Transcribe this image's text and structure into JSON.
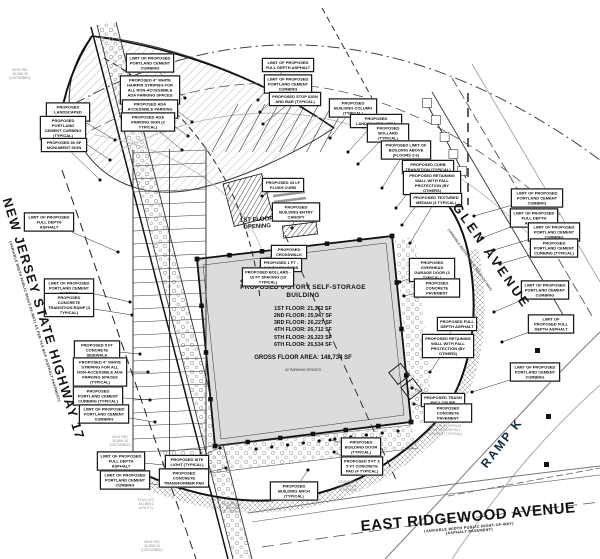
{
  "roads": {
    "nj17": {
      "name": "NEW JERSEY STATE HIGHWAY 17",
      "sub": "(VARIABLE WIDTH PUBLIC RIGHT-OF-WAY) AS PER TAX MAP (ASPHALT PAVEMENT)"
    },
    "glen": {
      "name": "GLEN AVENUE",
      "sub": "(VARIABLE WIDTH PUBLIC RIGHT-OF-WAY)"
    },
    "ramp_k": {
      "name": "RAMP K"
    },
    "east_ridgewood": {
      "name": "EAST RIDGEWOOD AVENUE",
      "sub1": "(VARIABLE WIDTH PUBLIC RIGHT-OF-WAY)",
      "sub2": "(ASPHALT PAVEMENT)"
    }
  },
  "building": {
    "title": "PROPOSED 6-STORY SELF-STORAGE BUILDING",
    "floors": [
      "1ST FLOOR: 21,362 SF",
      "2ND FLOOR: 25,947 SF",
      "3RD FLOOR: 26,227 SF",
      "4TH FLOOR: 26,712 SF",
      "5TH FLOOR: 26,323 SF",
      "6TH FLOOR: 26,534 SF"
    ],
    "gross": "GROSS FLOOR AREA: 148,734 SF",
    "parking": "42 PARKING SPACES",
    "opening_label": "1ST FLOOR OPENING"
  },
  "callouts": [
    {
      "text": "LIMIT OF PROPOSED PORTLAND CEMENT CURBING",
      "x": 150,
      "y": 63,
      "w": 42,
      "tx": 185,
      "ty": 98
    },
    {
      "text": "PROPOSED 4\" WHITE HAIRPIN STRIPING FOR ALL NON-ACCESSIBLE ADA PARKING SPACES (TYPICAL)",
      "x": 150,
      "y": 90,
      "w": 54,
      "tx": 192,
      "ty": 122
    },
    {
      "text": "PROPOSED ADA ACCESSIBLE PARKING AREA",
      "x": 150,
      "y": 109,
      "w": 50,
      "tx": 188,
      "ty": 136
    },
    {
      "text": "PROPOSED ADA PARKING SIGN (2 TYPICAL)",
      "x": 148,
      "y": 122,
      "w": 48,
      "tx": 182,
      "ty": 150
    },
    {
      "text": "PROPOSED LANDSCAPED AREA",
      "x": 68,
      "y": 112,
      "w": 38,
      "tx": 115,
      "ty": 140
    },
    {
      "text": "PROPOSED PORTLAND CEMENT CURBING (TYPICAL)",
      "x": 63,
      "y": 128,
      "w": 40,
      "tx": 110,
      "ty": 160
    },
    {
      "text": "PROPOSED 80 SF MONUMENT SIGN",
      "x": 64,
      "y": 145,
      "w": 40,
      "tx": 100,
      "ty": 180
    },
    {
      "text": "LIMIT OF PROPOSED FULL DEPTH ASPHALT",
      "x": 288,
      "y": 65,
      "w": 46,
      "tx": 258,
      "ty": 100
    },
    {
      "text": "LIMIT OF PROPOSED PORTLAND CEMENT CURBING",
      "x": 288,
      "y": 84,
      "w": 42,
      "tx": 260,
      "ty": 112
    },
    {
      "text": "PROPOSED STOP SIGN AND BAR (TYPICAL)",
      "x": 295,
      "y": 99,
      "w": 46,
      "tx": 263,
      "ty": 124
    },
    {
      "text": "PROPOSED BUILDING COLUMN (TYPICAL)",
      "x": 353,
      "y": 108,
      "w": 42,
      "tx": 330,
      "ty": 138
    },
    {
      "text": "PROPOSED LANDSCAPED AREA",
      "x": 376,
      "y": 121,
      "w": 46,
      "tx": 348,
      "ty": 152
    },
    {
      "text": "PROPOSED BOLLARD (TYPICAL)",
      "x": 388,
      "y": 133,
      "w": 36,
      "tx": 358,
      "ty": 164
    },
    {
      "text": "PROPOSED LIMIT OF BUILDING ABOVE (FLOORS 2-6)",
      "x": 406,
      "y": 150,
      "w": 44,
      "tx": 382,
      "ty": 188
    },
    {
      "text": "PROPOSED CURB TRANSITION (TYPICAL)",
      "x": 428,
      "y": 167,
      "w": 46,
      "tx": 396,
      "ty": 208
    },
    {
      "text": "PROPOSED RETAINING WALL WITH FALL PROTECTION (BY OTHERS)",
      "x": 432,
      "y": 183,
      "w": 52,
      "tx": 402,
      "ty": 225
    },
    {
      "text": "PROPOSED TEXTURED MEDIAN (3 TYPICAL)",
      "x": 436,
      "y": 200,
      "w": 46,
      "tx": 410,
      "ty": 243
    },
    {
      "text": "LIMIT OF PROPOSED FULL DEPTH ASPHALT",
      "x": 49,
      "y": 222,
      "w": 44,
      "tx": 118,
      "ty": 252
    },
    {
      "text": "LIMIT OF PROPOSED PORTLAND CEMENT CURBING",
      "x": 69,
      "y": 288,
      "w": 44,
      "tx": 130,
      "ty": 302
    },
    {
      "text": "PROPOSED CONCRETE TRANSITION RAMP (3 TYPICAL)",
      "x": 69,
      "y": 305,
      "w": 44,
      "tx": 132,
      "ty": 315
    },
    {
      "text": "PROPOSED 5 FT CONCRETE SIDEWALK",
      "x": 97,
      "y": 350,
      "w": 40,
      "tx": 140,
      "ty": 354
    },
    {
      "text": "PROPOSED 4\" WHITE STRIPING FOR ALL NON-ACCESSIBLE ADA PARKING SPACES (TYPICAL)",
      "x": 100,
      "y": 372,
      "w": 48,
      "tx": 148,
      "ty": 372
    },
    {
      "text": "PROPOSED PORTLAND CEMENT CURBING (TYPICAL)",
      "x": 98,
      "y": 396,
      "w": 44,
      "tx": 150,
      "ty": 400
    },
    {
      "text": "LIMIT OF PROPOSED PORTLAND CEMENT CURBING",
      "x": 104,
      "y": 414,
      "w": 44,
      "tx": 155,
      "ty": 422
    },
    {
      "text": "LIMIT OF PROPOSED FULL DEPTH ASPHALT",
      "x": 121,
      "y": 461,
      "w": 42,
      "tx": 176,
      "ty": 466
    },
    {
      "text": "LIMIT OF PROPOSED PORTLAND CEMENT CURBING",
      "x": 125,
      "y": 480,
      "w": 44,
      "tx": 180,
      "ty": 488
    },
    {
      "text": "LIMIT OF PROPOSED PORTLAND CEMENT CURBING",
      "x": 537,
      "y": 198,
      "w": 46,
      "tx": 474,
      "ty": 216
    },
    {
      "text": "LIMIT OF PROPOSED FULL DEPTH ASPHALT",
      "x": 534,
      "y": 218,
      "w": 42,
      "tx": 482,
      "ty": 238
    },
    {
      "text": "LIMIT OF PROPOSED PORTLAND CEMENT CURBING",
      "x": 554,
      "y": 232,
      "w": 46,
      "tx": 494,
      "ty": 250
    },
    {
      "text": "PROPOSED PORTLAND CEMENT CURBING (TYPICAL)",
      "x": 554,
      "y": 248,
      "w": 42,
      "tx": 500,
      "ty": 264
    },
    {
      "text": "LIMIT OF PROPOSED PORTLAND CEMENT CURBING",
      "x": 545,
      "y": 290,
      "w": 42,
      "tx": 494,
      "ty": 312
    },
    {
      "text": "LIMIT OF PROPOSED FULL DEPTH ASPHALT",
      "x": 551,
      "y": 324,
      "w": 40,
      "tx": 502,
      "ty": 342
    },
    {
      "text": "PROPOSED FULL DEPTH ASPHALT",
      "x": 457,
      "y": 324,
      "w": 34,
      "tx": 440,
      "ty": 346
    },
    {
      "text": "PROPOSED RETAINING WALL WITH FALL PROTECTION (BY OTHERS)",
      "x": 448,
      "y": 346,
      "w": 46,
      "tx": 430,
      "ty": 372
    },
    {
      "text": "LIMIT OF PROPOSED PORTLAND CEMENT CURBING",
      "x": 535,
      "y": 372,
      "w": 44,
      "tx": 472,
      "ty": 392
    },
    {
      "text": "PROPOSED 33 LF FLUSH CURB",
      "x": 283,
      "y": 185,
      "w": 36,
      "tx": 262,
      "ty": 196
    },
    {
      "text": "PROPOSED BUILDING ENTRY CANOPY",
      "x": 296,
      "y": 212,
      "w": 42,
      "tx": 292,
      "ty": 228
    },
    {
      "text": "PROPOSED CROSSWALK",
      "x": 289,
      "y": 252,
      "w": 30,
      "tx": 272,
      "ty": 256
    },
    {
      "text": "PROPOSED 1 FT - 0 IN FLUSH CURB",
      "x": 281,
      "y": 265,
      "w": 36,
      "tx": 260,
      "ty": 268
    },
    {
      "text": "PROPOSED BOLLARD - 10 FT SPACING (10 TYPICAL)",
      "x": 268,
      "y": 277,
      "w": 46,
      "tx": 242,
      "ty": 281
    },
    {
      "text": "PROPOSED OVERHEAD GARAGE DOOR (3 TYPICAL)",
      "x": 432,
      "y": 270,
      "w": 40,
      "tx": 400,
      "ty": 282
    },
    {
      "text": "PROPOSED CONCRETE PAVEMENT",
      "x": 437,
      "y": 288,
      "w": 40,
      "tx": 404,
      "ty": 296
    },
    {
      "text": "PROPOSED TRASH ENCLOSURE",
      "x": 443,
      "y": 400,
      "w": 38,
      "tx": 412,
      "ty": 388
    },
    {
      "text": "PROPOSED CONCRETE PAVEMENT",
      "x": 448,
      "y": 413,
      "w": 42,
      "tx": 414,
      "ty": 404
    },
    {
      "text": "PROPOSED BUILDING DOOR (TYPICAL)",
      "x": 361,
      "y": 447,
      "w": 34,
      "tx": 330,
      "ty": 440
    },
    {
      "text": "PROPOSED 5 FT X 5 FT CONCRETE PAD (4 TYPICAL)",
      "x": 362,
      "y": 466,
      "w": 36,
      "tx": 334,
      "ty": 452
    },
    {
      "text": "PROPOSED BUILDING ARCH (TYPICAL)",
      "x": 294,
      "y": 491,
      "w": 42,
      "tx": 308,
      "ty": 470
    },
    {
      "text": "PROPOSED SITE LIGHT (TYPICAL)",
      "x": 187,
      "y": 462,
      "w": 38,
      "tx": 220,
      "ty": 448
    },
    {
      "text": "PROPOSED CONCRETE TRANSFORMER PAD",
      "x": 184,
      "y": 478,
      "w": 44,
      "tx": 226,
      "ty": 468
    }
  ],
  "survey_notes": [
    {
      "x": 20,
      "y": 74,
      "lines": "MON FND\n28.59/9.06\n(DISTURBED)"
    },
    {
      "x": 120,
      "y": 441,
      "lines": "MON FND\n28.59/9.18\n(DISTURBED)"
    },
    {
      "x": 146,
      "y": 504,
      "lines": "POLE (UT)\n28.198/9.2\n(UTILITY)"
    },
    {
      "x": 152,
      "y": 546,
      "lines": "MON FND\n28.59/9.16\n(DISTURBED)"
    },
    {
      "x": 232,
      "y": 508,
      "lines": "MONUMENT\n(R.O.W.)\n(EXISTING)"
    },
    {
      "x": 348,
      "y": 486,
      "lines": "MONUMENT\n28.59/9.24\n(EXISTING)"
    },
    {
      "x": 445,
      "y": 430,
      "lines": "MILL 2 IN & OVERLAY\nEXISTING ASPHALT\nPAVEMENT (TYPICAL)"
    }
  ],
  "colors": {
    "paper": "#ffffff",
    "line": "#1a1a1a",
    "grey": "#8e8e8e",
    "building_fill": "#dcdcdc",
    "hatch": "#bdbdbd"
  }
}
